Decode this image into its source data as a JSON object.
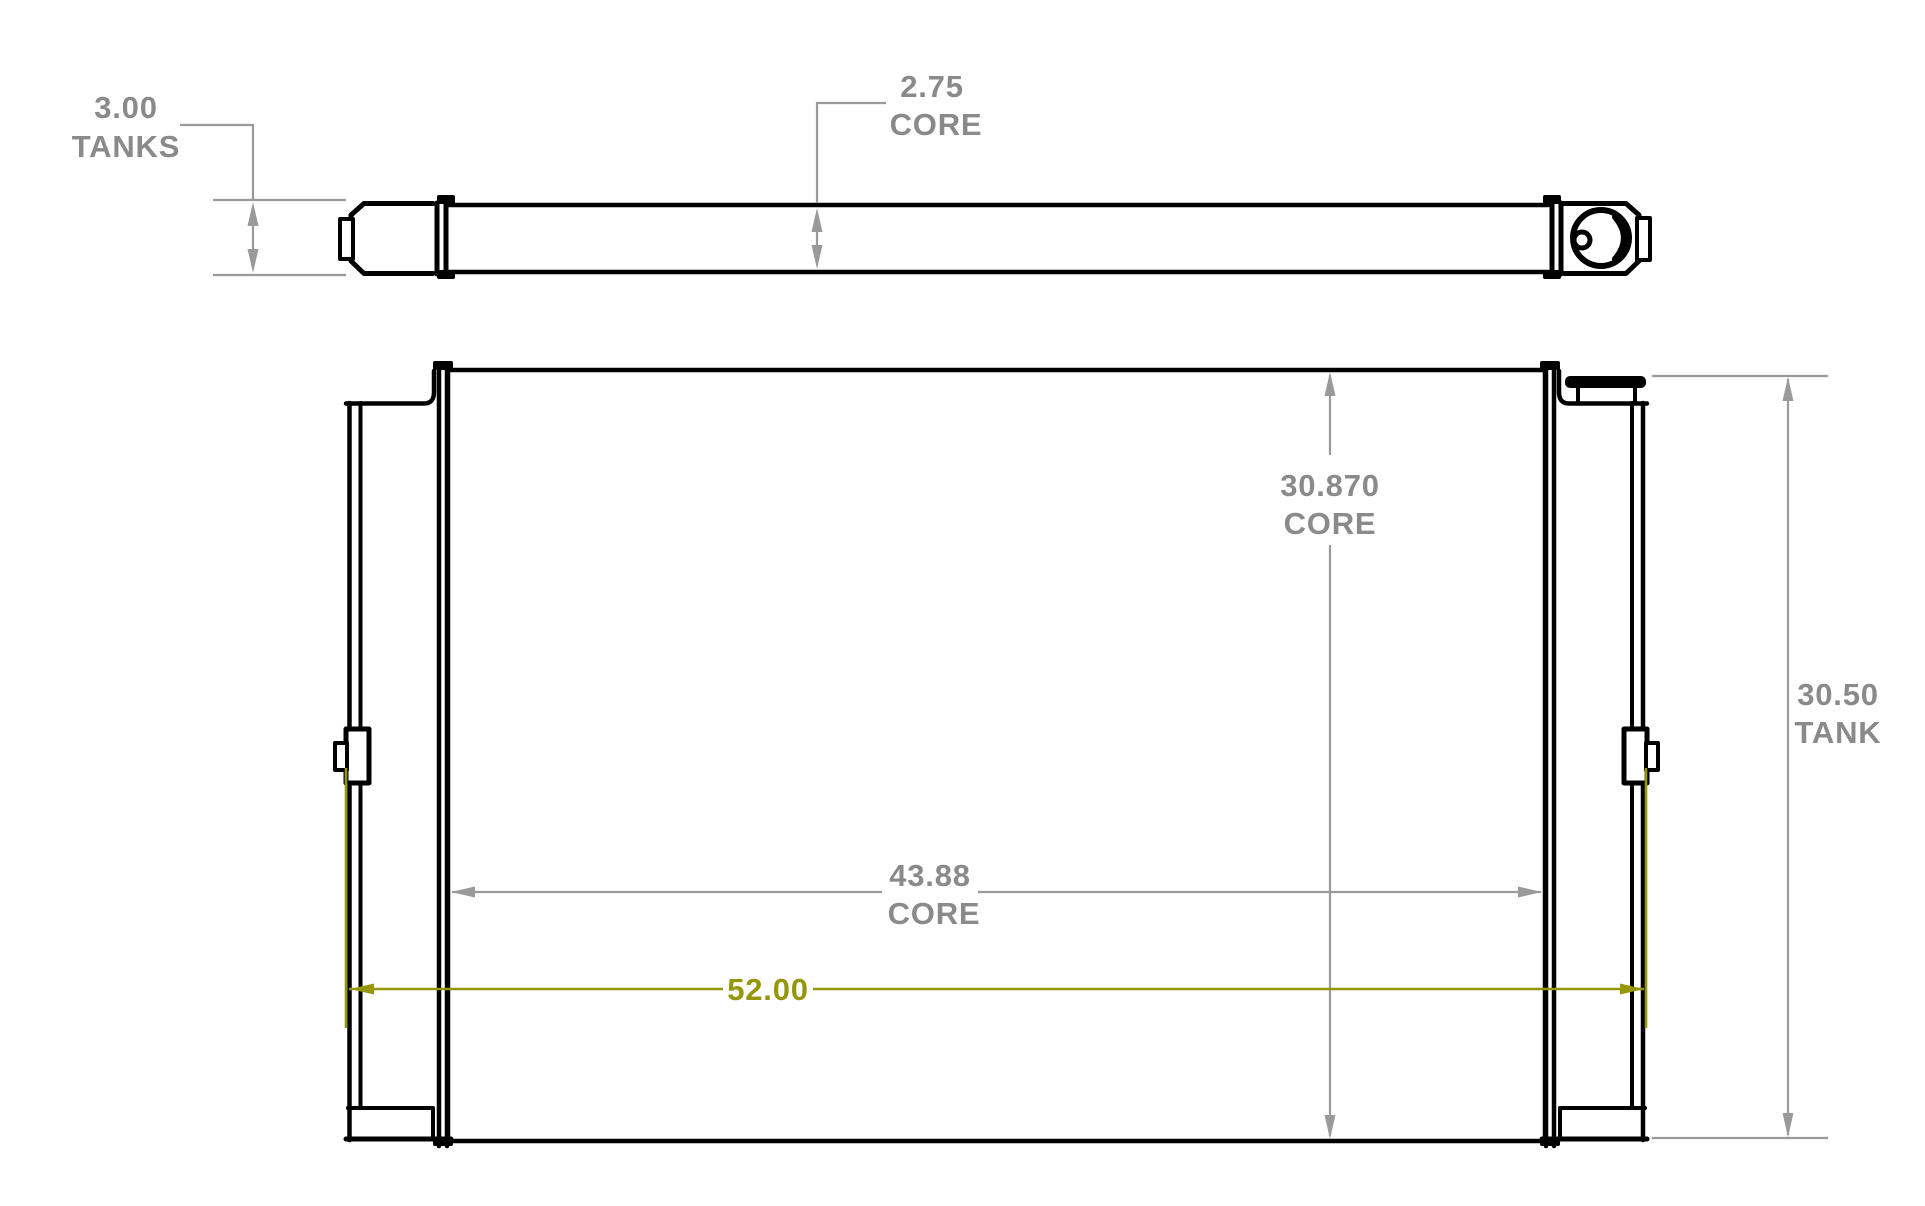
{
  "drawing": {
    "type": "engineering-dimension-drawing",
    "views": {
      "top_view": {
        "dim_tanks": {
          "value": "3.00",
          "label": "TANKS"
        },
        "dim_core": {
          "value": "2.75",
          "label": "CORE"
        }
      },
      "front_view": {
        "dim_core_height": {
          "value": "30.870",
          "label": "CORE"
        },
        "dim_core_width": {
          "value": "43.88",
          "label": "CORE"
        },
        "dim_overall_width": {
          "value": "52.00"
        },
        "dim_tank_height": {
          "value": "30.50",
          "label": "TANK"
        }
      }
    },
    "colors": {
      "object_line": "#000000",
      "dimension": "#8a8a8a",
      "dimension_line": "#9a9a9a",
      "highlight": "#96960a",
      "background": "#ffffff"
    }
  }
}
